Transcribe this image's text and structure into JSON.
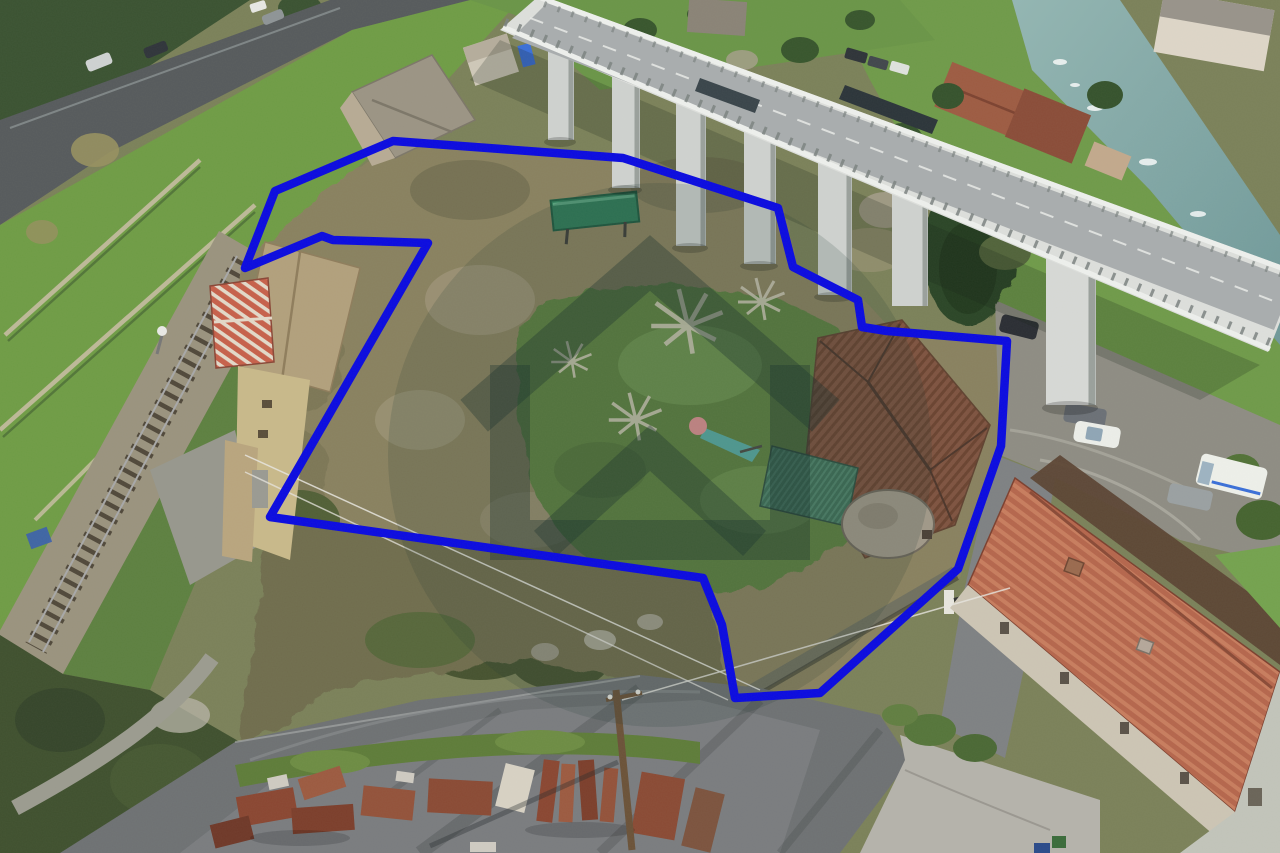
{
  "image": {
    "kind": "aerial-drone-photo",
    "description": "Aerial view of a hillside land parcel for sale outlined in blue, with an overgrown garden and lawn, an old farmhouse, a house by a railway line, a concrete highway viaduct on piers, a river with red-roofed houses at top right, terraced meadows and a road at top left, and a lower road with stacked rusty scaffolding material at the bottom.",
    "width_px": 1280,
    "height_px": 853
  },
  "overlay": {
    "boundary": {
      "name": "property-boundary-outline",
      "color": "#0a0ae0",
      "stroke_width": 8.5,
      "points": "393,141 623,158 778,208 793,267 858,300 862,327 887,331 1007,341 1001,446 958,569 820,693 735,698 722,625 703,578 270,517 428,243 333,240 322,236 245,268 275,191"
    },
    "watermark": {
      "name": "agency-house-logo-watermark",
      "center_x": 660,
      "center_y": 455,
      "radius": 272,
      "disc_fill": "rgba(30,58,52,0.16)",
      "stroke": "rgba(22,48,44,0.34)"
    }
  },
  "scene": {
    "palette": {
      "meadow_green": "#6f9c45",
      "scrub_olive": "#89815f",
      "lawn_green": "#5b7f40",
      "dark_conifer": "#2c4526",
      "asphalt_grey": "#6e7173",
      "concrete_light": "#dddfdc",
      "river_teal": "#7ba6a6",
      "roof_red": "#b5664c",
      "roof_brown": "#7e5340",
      "rust_red": "#8a4631",
      "gravel_grey": "#8e8c83",
      "boundary_blue": "#0a0ae0"
    },
    "objects": [
      {
        "name": "hillside-road",
        "desc": "two-lane road with cars, upper left"
      },
      {
        "name": "terraced-meadows",
        "desc": "green terraces with light stone walls"
      },
      {
        "name": "railway-track",
        "desc": "single railway track crossing the left side"
      },
      {
        "name": "viaduct",
        "desc": "white concrete highway viaduct on tall piers"
      },
      {
        "name": "river",
        "desc": "stream with rapids, upper right"
      },
      {
        "name": "riverside-houses",
        "desc": "cluster of red-roofed houses along the river"
      },
      {
        "name": "parcel-scrub",
        "desc": "overgrown brush with bare trees inside the boundary"
      },
      {
        "name": "parcel-lawn",
        "desc": "green lawn with a small children's slide"
      },
      {
        "name": "left-house",
        "desc": "house with striped red roof beside the railway"
      },
      {
        "name": "farmhouse",
        "desc": "old farmhouse with brown tiled roof and round stone annex"
      },
      {
        "name": "green-shed",
        "desc": "green corrugated lean-to roof"
      },
      {
        "name": "parking-area",
        "desc": "gravel parking with cars and a white van under the viaduct"
      },
      {
        "name": "bottom-right-house",
        "desc": "long red-roofed house with grey gable and concrete yard"
      },
      {
        "name": "bottom-road",
        "desc": "asphalt road junction at the bottom with long shadows"
      },
      {
        "name": "material-stacks",
        "desc": "stacks of rusty scaffolding frames"
      },
      {
        "name": "utility-pole",
        "desc": "wooden utility pole with overhead wires"
      }
    ]
  }
}
